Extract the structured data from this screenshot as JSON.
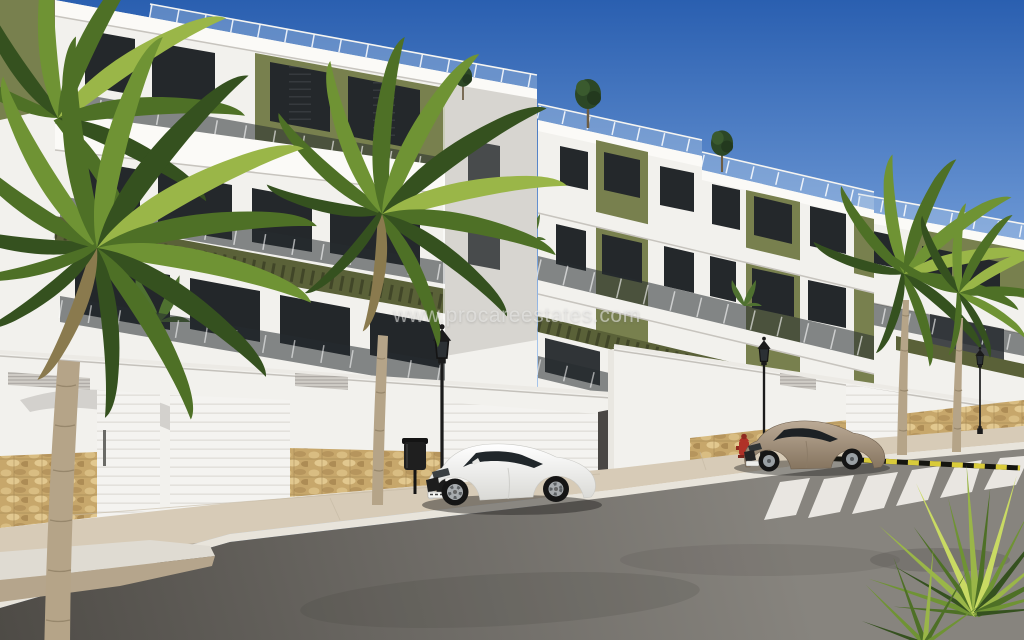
{
  "image": {
    "type": "3d architectural render / real-estate photo",
    "subject": "New-build white apartment complex street scene with palm trees, perimeter wall, garage doors and two parked coupes",
    "width_px": 1024,
    "height_px": 640
  },
  "watermark": {
    "text": "www.procareestates.com"
  },
  "colors": {
    "sky-top": "#2a5fb0",
    "sky-low": "#a6c4ea",
    "facade-white": "#f2f1ed",
    "facade-bright": "#fbfaf7",
    "facade-side": "#d7d5d0",
    "accent-olive": "#78804e",
    "accent-olive-dark": "#5a6138",
    "window-dark": "#24282b",
    "stone": "#c7a76b",
    "sidewalk": "#d7cbb7",
    "curb": "#e8e4db",
    "road-light": "#807d78",
    "road-dark": "#504d48",
    "marking-white": "#f1efe9",
    "marking-yellow": "#d9cb3a",
    "car-white": "#f4f4f2",
    "car-beige": "#a5917b",
    "palm-trunk": "#b5a488",
    "lamp-black": "#1b1b1b",
    "hydrant-red": "#b03227"
  },
  "scene": {
    "sky": "clear blue gradient",
    "buildings": [
      {
        "label": "left apartment block",
        "facade": [
          "white",
          "olive-green accent block"
        ],
        "features": [
          "roof terrace glass railing",
          "tinted glass balcony balustrades",
          "green pergola band",
          "dark ground-floor terraces"
        ]
      },
      {
        "label": "middle apartment block",
        "facade": [
          "white",
          "olive-green vertical panels"
        ],
        "features": [
          "stepped roof terraces with small trees",
          "balconies",
          "dark slatted pergola over ground terraces"
        ]
      },
      {
        "label": "right apartment block",
        "facade": [
          "white",
          "olive-green band"
        ],
        "features": [
          "roof railing",
          "balcony glass"
        ]
      }
    ],
    "street": {
      "elements": [
        "white perimeter wall with natural stone base",
        "white sectional garage doors",
        "ventilation grilles",
        "paved sidewalk",
        "asphalt road",
        "pedestrian crossing stripes",
        "yellow-black painted kerb line",
        "gravel planter"
      ],
      "furniture": [
        "classic black street lamps",
        "black litter bin",
        "red fire hydrant"
      ]
    },
    "vehicles": [
      {
        "label": "white sports coupe, parked facing left"
      },
      {
        "label": "beige coupe, parked facing left"
      }
    ],
    "vegetation": [
      "large palm tree left foreground",
      "second palm by wall",
      "two palms in front of right block",
      "spiky palm shrub bottom right",
      "rooftop trees",
      "terrace plants"
    ]
  }
}
